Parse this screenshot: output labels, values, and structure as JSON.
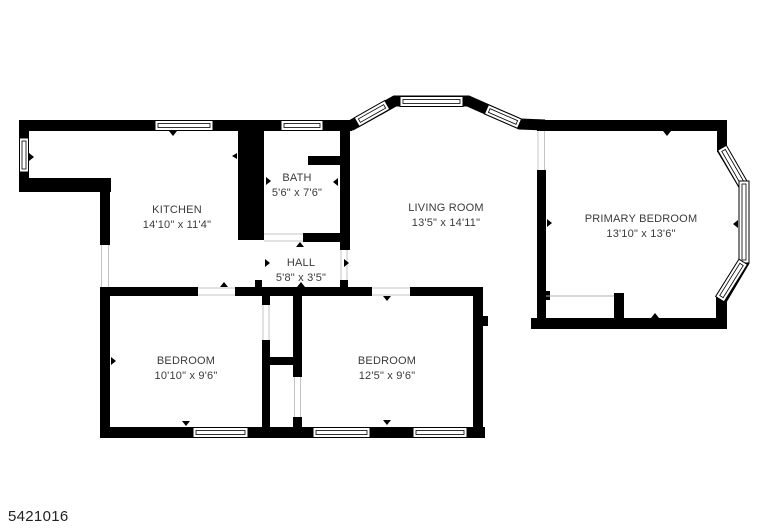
{
  "plan_id": "5421016",
  "colors": {
    "wall": "#000000",
    "text": "#3b3b3b",
    "background": "#ffffff"
  },
  "rooms": {
    "kitchen": {
      "name": "KITCHEN",
      "dims": "14'10\" x 11'4\""
    },
    "bath": {
      "name": "BATH",
      "dims": "5'6\" x 7'6\""
    },
    "living_room": {
      "name": "LIVING ROOM",
      "dims": "13'5\" x 14'11\""
    },
    "primary_bedroom": {
      "name": "PRIMARY BEDROOM",
      "dims": "13'10\" x 13'6\""
    },
    "hall": {
      "name": "HALL",
      "dims": "5'8\" x 3'5\""
    },
    "bedroom_left": {
      "name": "BEDROOM",
      "dims": "10'10\" x 9'6\""
    },
    "bedroom_right": {
      "name": "BEDROOM",
      "dims": "12'5\" x 9'6\""
    }
  }
}
